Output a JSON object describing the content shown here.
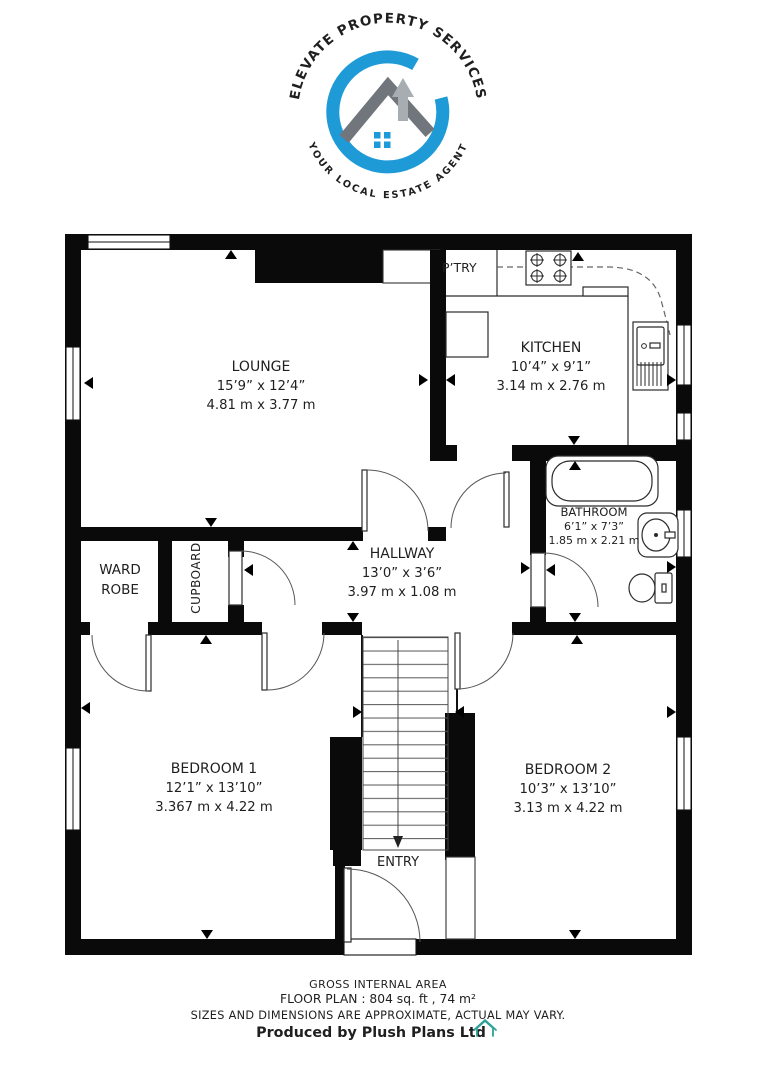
{
  "logo": {
    "arc_top": "ELEVATE PROPERTY SERVICES",
    "arc_bottom": "YOUR LOCAL ESTATE AGENT"
  },
  "rooms": {
    "lounge": {
      "name": "LOUNGE",
      "imperial": "15’9” x 12’4”",
      "metric": "4.81 m x 3.77 m"
    },
    "kitchen": {
      "name": "KITCHEN",
      "imperial": "10’4” x 9’1”",
      "metric": "3.14 m x 2.76 m"
    },
    "pantry": {
      "name": "P’TRY"
    },
    "bathroom": {
      "name": "BATHROOM",
      "imperial": "6’1” x 7’3”",
      "metric": "1.85 m x 2.21 m"
    },
    "hallway": {
      "name": "HALLWAY",
      "imperial": "13’0” x 3’6”",
      "metric": "3.97 m x 1.08 m"
    },
    "wardrobe": {
      "line1": "WARD",
      "line2": "ROBE"
    },
    "cupboard": {
      "name": "CUPBOARD"
    },
    "bedroom1": {
      "name": "BEDROOM 1",
      "imperial": "12’1” x 13’10”",
      "metric": "3.367 m x 4.22 m"
    },
    "bedroom2": {
      "name": "BEDROOM 2",
      "imperial": "10’3” x 13’10”",
      "metric": "3.13 m x 4.22 m"
    },
    "entry": {
      "name": "ENTRY"
    }
  },
  "footer": {
    "line1": "GROSS INTERNAL AREA",
    "line2": "FLOOR PLAN : 804 sq. ft , 74 m²",
    "line3": "SIZES AND DIMENSIONS ARE APPROXIMATE, ACTUAL MAY VARY.",
    "line4": "Produced by Plush Plans Ltd"
  },
  "colors": {
    "logo_blue": "#1e9bd7",
    "logo_gray": "#8e8e8e",
    "roof_gray": "#70767c",
    "arrow_silver": "#a8adb2",
    "footer_blue": "#3c6492",
    "footer_muted": "#bdbdbd",
    "house_teal": "#2fa097"
  }
}
